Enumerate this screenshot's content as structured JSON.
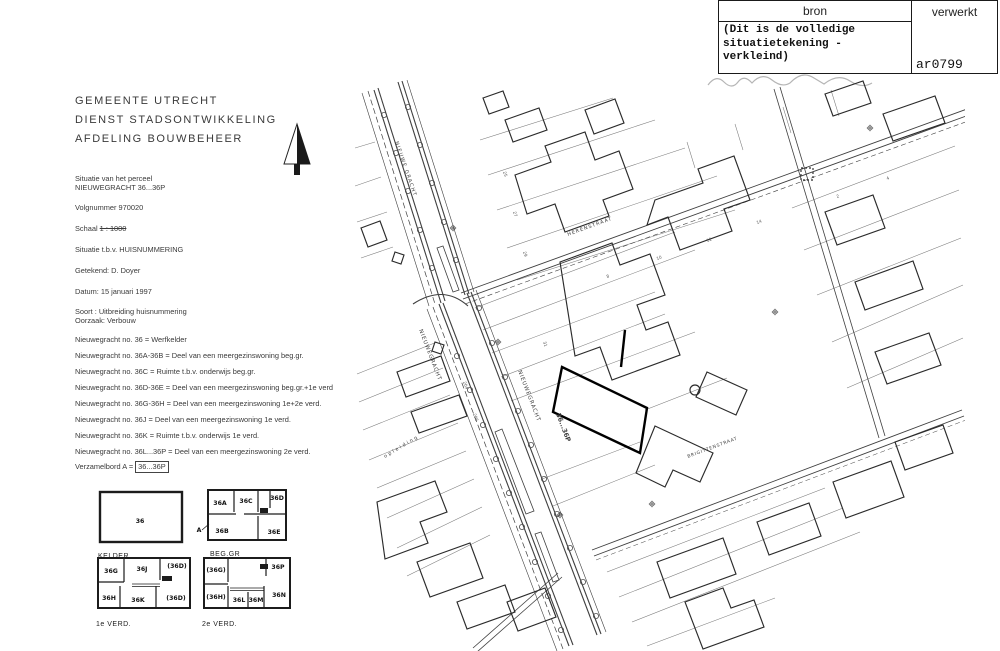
{
  "colors": {
    "paper": "#ffffff",
    "ink": "#2e2e2e",
    "map_line": "#4a4a4a",
    "bold_parcel": "#000000",
    "table_border": "#1a1a1a"
  },
  "header_table": {
    "bron_label": "bron",
    "verwerkt_label": "verwerkt",
    "bron_note": "(Dit is de volledige\n situatietekening -\n verkleind)",
    "verwerkt_value": "ar0799"
  },
  "letterhead": {
    "line1": "GEMEENTE  UTRECHT",
    "line2": "DIENST STADSONTWIKKELING",
    "line3": "AFDELING BOUWBEHEER"
  },
  "details": {
    "situatie_label": "Situatie van het perceel",
    "situatie_value": "NIEUWEGRACHT 36...36P",
    "volgnummer": "Volgnummer 970020",
    "schaal_label": "Schaal",
    "schaal_value": "1 : 1000",
    "situatie_tbv": "Situatie t.b.v. HUISNUMMERING",
    "getekend": "Getekend: D. Doyer",
    "datum": "Datum: 15 januari 1997",
    "soort": "Soort : Uitbreiding huisnummering",
    "oorzaak": "Oorzaak: Verbouw"
  },
  "huisnummers": [
    "Nieuwegracht no. 36    = Werfkelder",
    "Nieuwegracht no. 36A-36B = Deel van een meergezinswoning beg.gr.",
    "Nieuwegracht no. 36C = Ruimte t.b.v. onderwijs beg.gr.",
    "Nieuwegracht no. 36D-36E = Deel van een meergezinswoning beg.gr.+1e verd",
    "Nieuwegracht no. 36G-36H = Deel van een meergezinswoning 1e+2e verd.",
    "Nieuwegracht no. 36J = Deel van een meergezinswoning 1e verd.",
    "Nieuwegracht no. 36K = Ruimte t.b.v. onderwijs 1e verd.",
    "Nieuwegracht no. 36L...36P = Deel van een meergezinswoning 2e verd."
  ],
  "verzamelbord": {
    "label": "Verzamelbord A =",
    "value": "36...36P"
  },
  "floor_plans": {
    "kelder": {
      "title": "KELDER",
      "room": "36"
    },
    "beggr": {
      "title": "BEG.GR",
      "annotation": "A",
      "rooms": [
        "36A",
        "36C",
        "36D",
        "36B",
        "36E"
      ]
    },
    "verd1": {
      "title": "1e VERD.",
      "rooms": [
        "36G",
        "36J",
        "(36D)",
        "36H",
        "36K",
        "(36D)"
      ]
    },
    "verd2": {
      "title": "2e VERD.",
      "rooms": [
        "(36G)",
        "36P",
        "(36H)",
        "36L",
        "36M",
        "36N"
      ]
    }
  },
  "map": {
    "street_labels": {
      "nieuwe_gracht": "NIEUWE GRACHT",
      "nieuwegracht_1": "NIEUWEGRACHT",
      "nieuwegracht_2": "NIEUWEGRACHT",
      "herenstraat": "HERENSTRAAT",
      "brigittenstraat": "BRIGITTENSTRAAT",
      "opleiding": "opleiding"
    },
    "parcel_label": "36...36P",
    "house_numbers": [
      "25",
      "27",
      "29",
      "31",
      "8",
      "10",
      "12",
      "14",
      "204",
      "206",
      "2",
      "4"
    ]
  }
}
